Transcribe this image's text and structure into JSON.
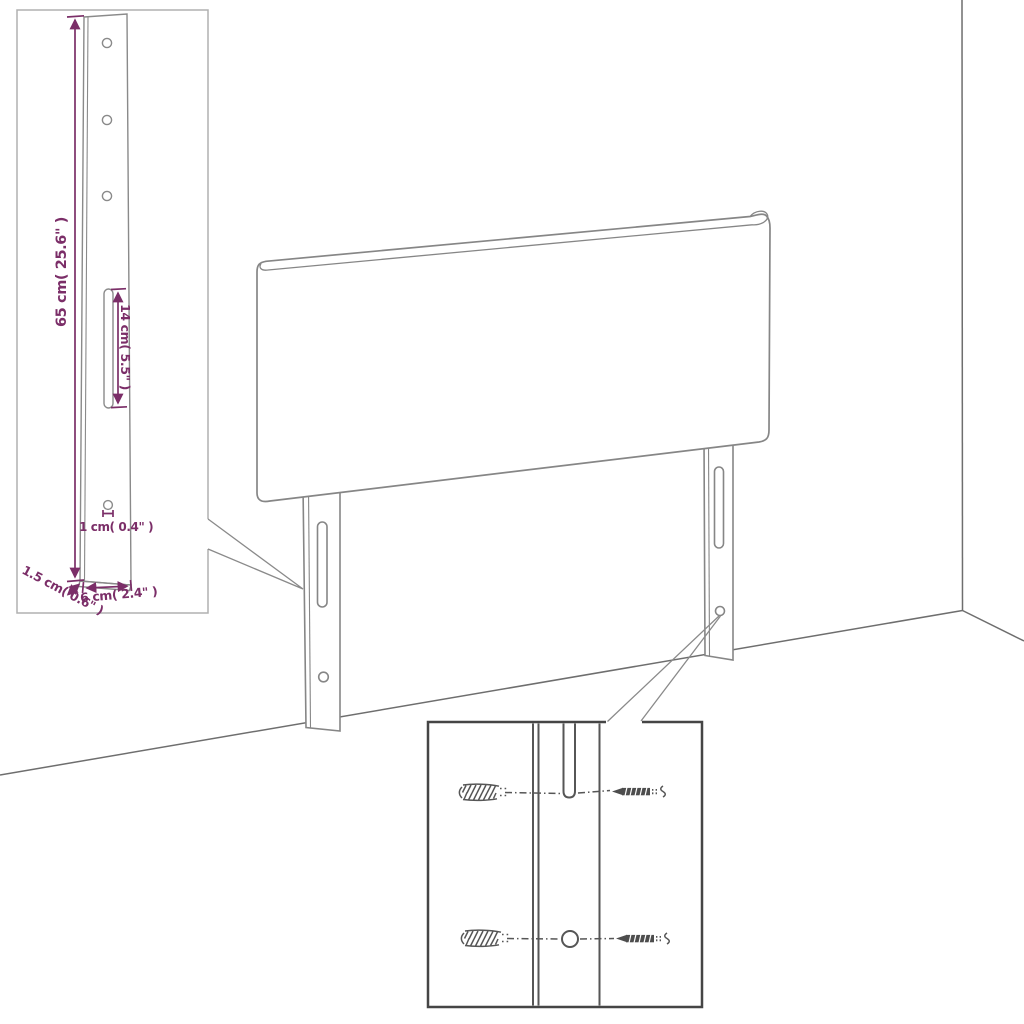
{
  "diagram": {
    "dimension_labels": {
      "leg_height": "65 cm( 25.6\" )",
      "slot_length": "14 cm( 5.5\" )",
      "hole_diameter": "1 cm( 0.4\" )",
      "leg_thickness": "1.5 cm( 0.6\" )",
      "leg_width": "6 cm( 2.4\" )"
    },
    "colors": {
      "dimension_text": "#7b2e68",
      "furniture_outline": "#868686",
      "room_lines": "#6e6e6e",
      "callout_box_light": "#b0b0b0",
      "callout_box_dark": "#454545",
      "detail_outline": "#565656",
      "background": "#ffffff"
    }
  }
}
